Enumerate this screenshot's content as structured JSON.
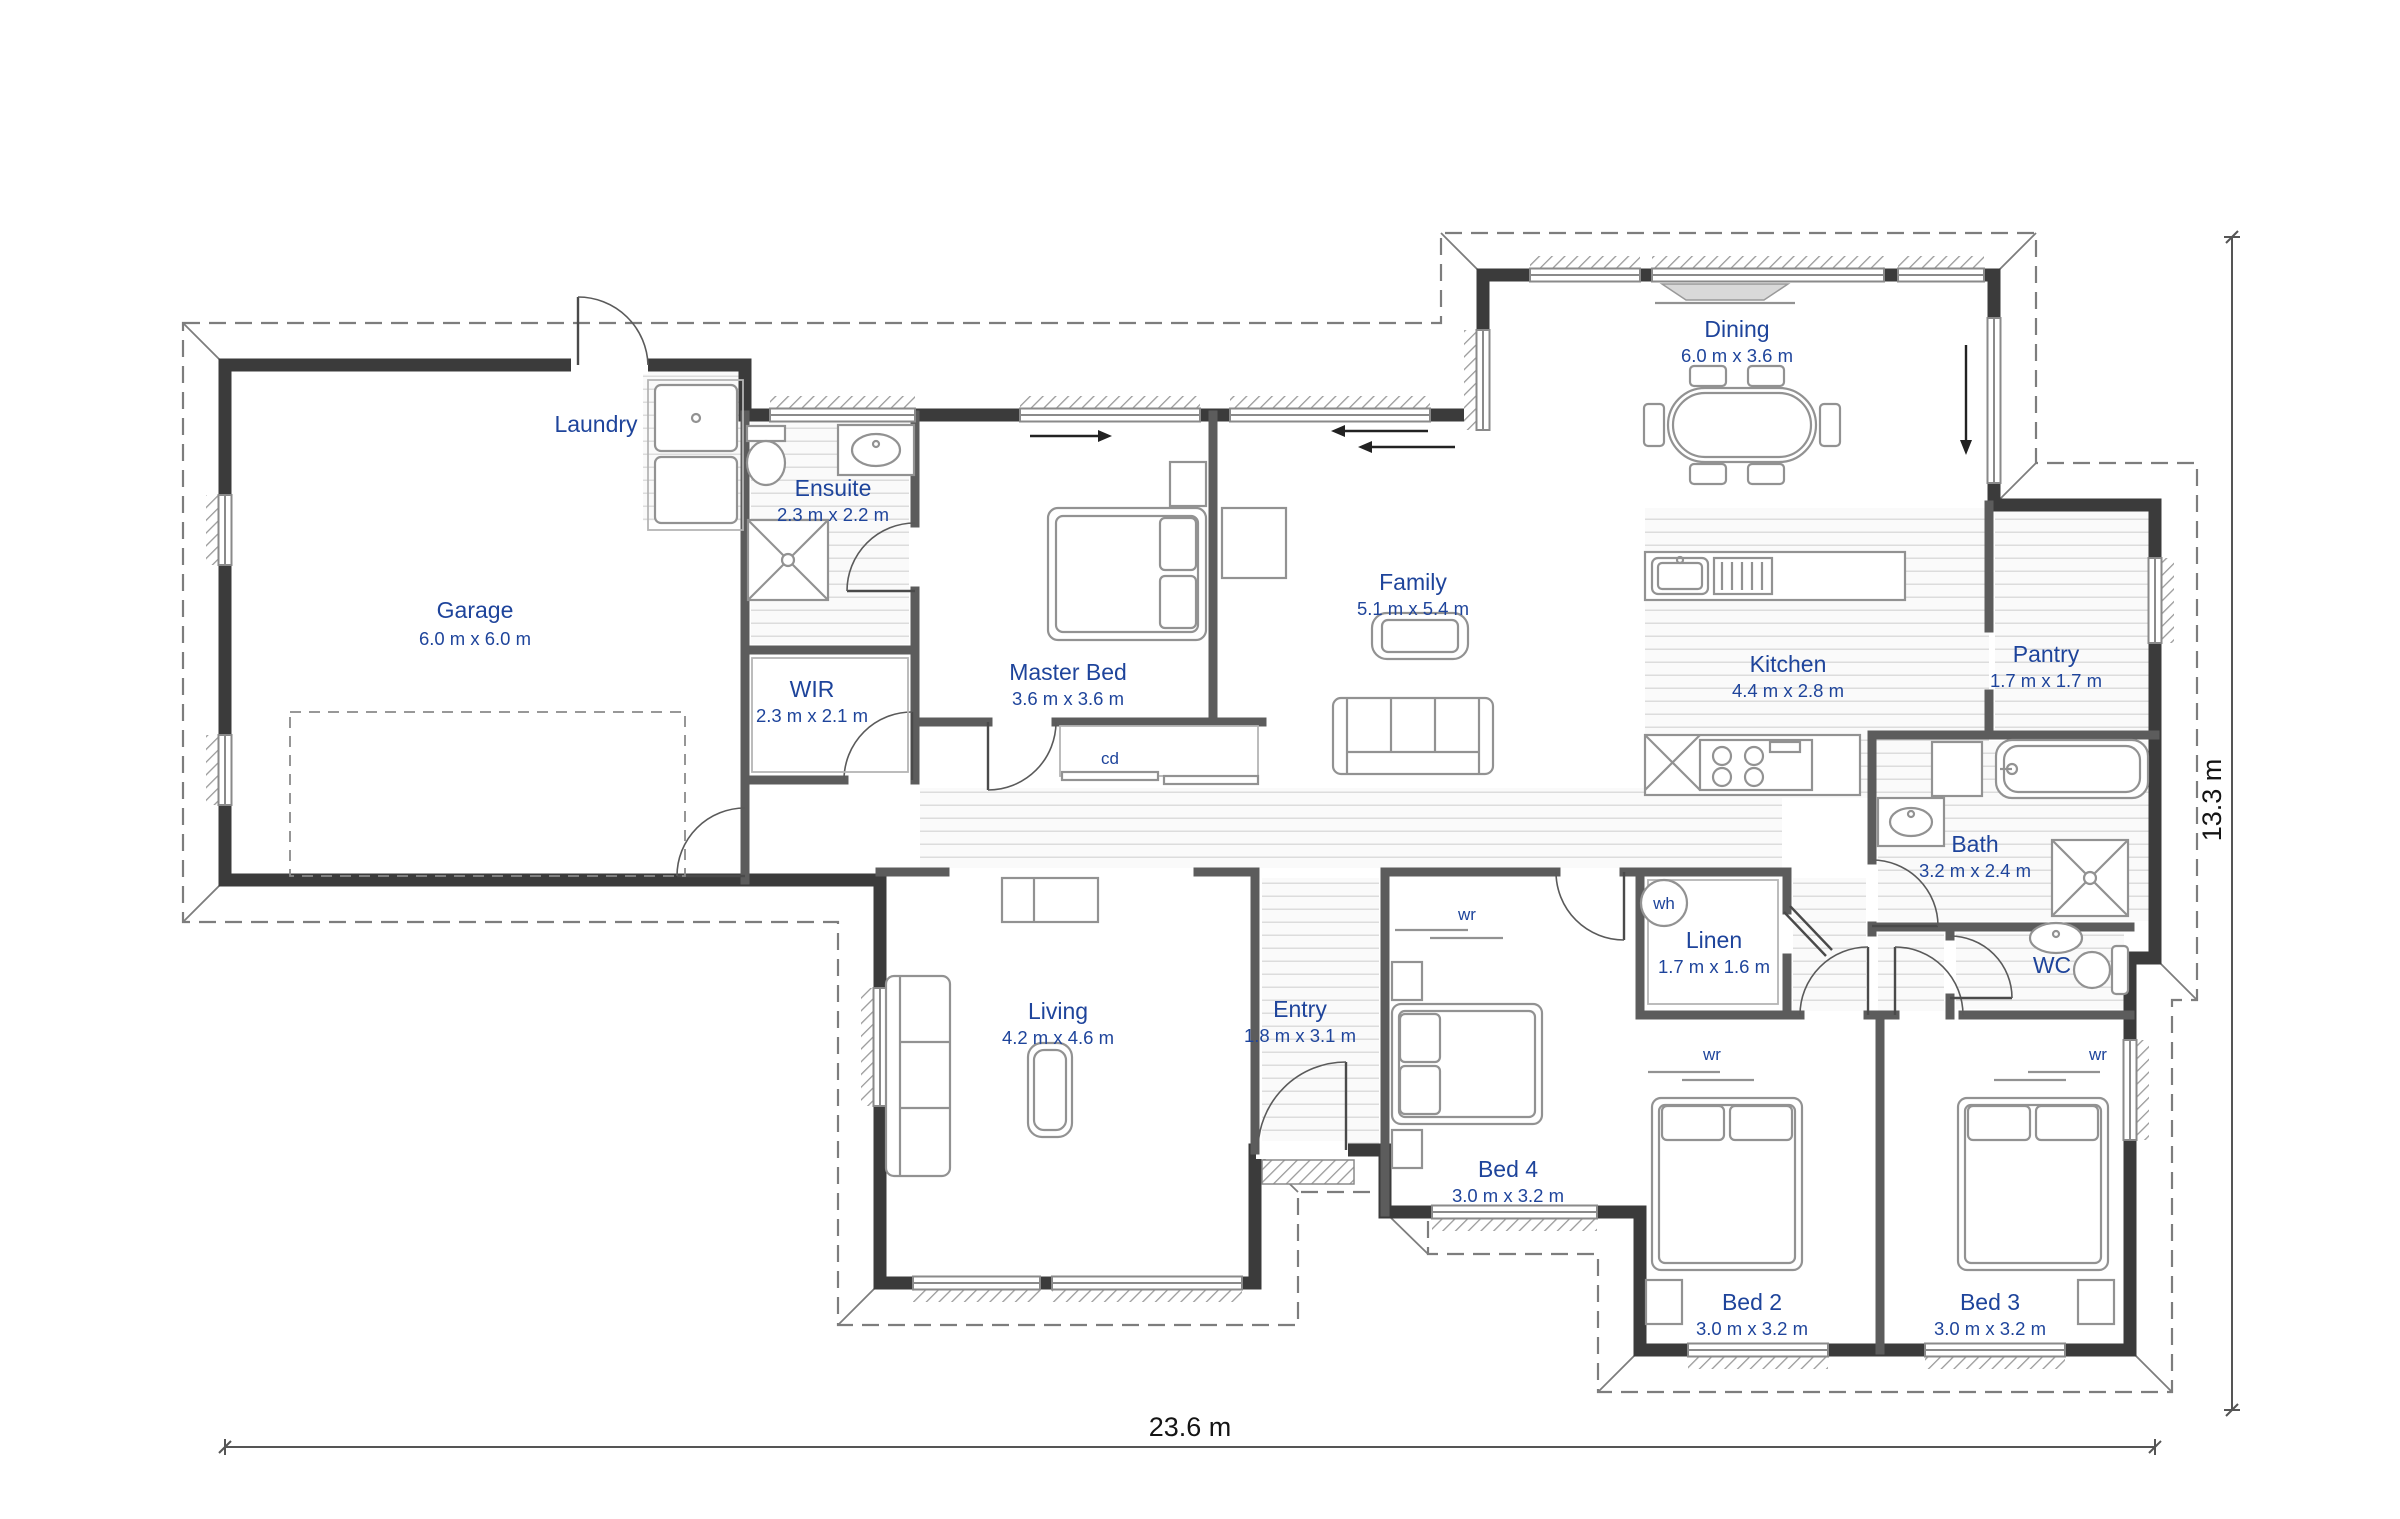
{
  "plan": {
    "rooms": [
      {
        "name": "Garage",
        "dims": "6.0 m x 6.0 m"
      },
      {
        "name": "Laundry",
        "dims": ""
      },
      {
        "name": "Ensuite",
        "dims": "2.3 m x 2.2 m"
      },
      {
        "name": "WIR",
        "dims": "2.3 m x 2.1 m"
      },
      {
        "name": "Master Bed",
        "dims": "3.6 m x 3.6 m"
      },
      {
        "name": "Family",
        "dims": "5.1 m x 5.4 m"
      },
      {
        "name": "Dining",
        "dims": "6.0 m x 3.6 m"
      },
      {
        "name": "Kitchen",
        "dims": "4.4 m x 2.8 m"
      },
      {
        "name": "Pantry",
        "dims": "1.7 m x 1.7 m"
      },
      {
        "name": "Bath",
        "dims": "3.2 m x 2.4 m"
      },
      {
        "name": "Linen",
        "dims": "1.7 m x 1.6 m"
      },
      {
        "name": "WC",
        "dims": ""
      },
      {
        "name": "Living",
        "dims": "4.2 m x 4.6 m"
      },
      {
        "name": "Entry",
        "dims": "1.8 m x 3.1 m"
      },
      {
        "name": "Bed 4",
        "dims": "3.0 m x 3.2 m"
      },
      {
        "name": "Bed 2",
        "dims": "3.0 m x 3.2 m"
      },
      {
        "name": "Bed 3",
        "dims": "3.0 m x 3.2 m"
      }
    ],
    "fixture_labels": {
      "wardrobe": "wr",
      "water_heater": "wh",
      "sliding_closet": "cd"
    },
    "overall": {
      "width_label": "23.6 m",
      "height_label": "13.3 m"
    },
    "colors": {
      "room_label": "#1e449b",
      "exterior_wall": "#3b3b3b",
      "interior_wall": "#5c5c5c",
      "dimension_text": "#141414"
    }
  }
}
